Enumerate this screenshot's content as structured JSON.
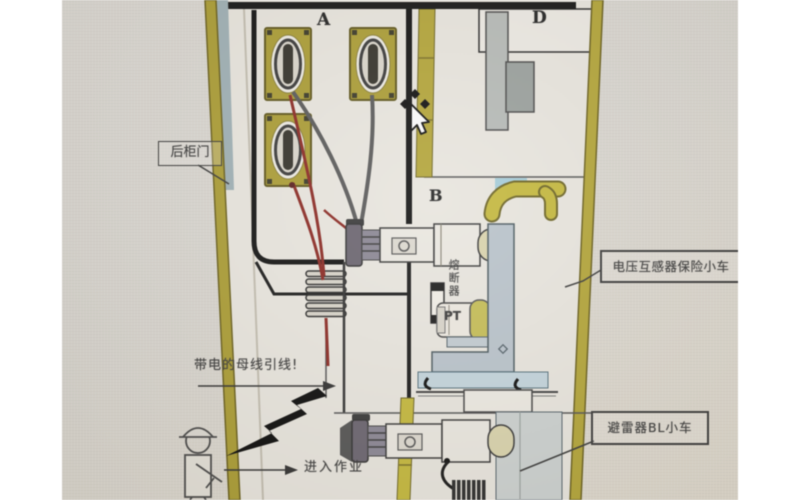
{
  "diagram": {
    "compartment_labels": {
      "a": "A",
      "b": "B",
      "d": "D"
    },
    "annotations": {
      "rear_door": "后柜门",
      "vt_fuse_trolley": "电压互感器保险小车",
      "arrester_trolley": "避雷器BL小车",
      "live_busbar_lead": "带电的母线引线!",
      "enter_work": "进入作业",
      "fuse": "熔断器",
      "pt": "PT"
    },
    "colors": {
      "screen_background": "#d8d5cf",
      "interior_background": "#e8e5de",
      "wall_olive": "#ab9d36",
      "frame_black": "#141414",
      "cable_red": "#8b2a24",
      "bracket_gray_blue": "#b9c3cb",
      "floor_light_blue": "#c3d4dc",
      "duct_yellow": "#c4b83e",
      "trolley_cap_khaki": "#d9d3ad"
    }
  }
}
